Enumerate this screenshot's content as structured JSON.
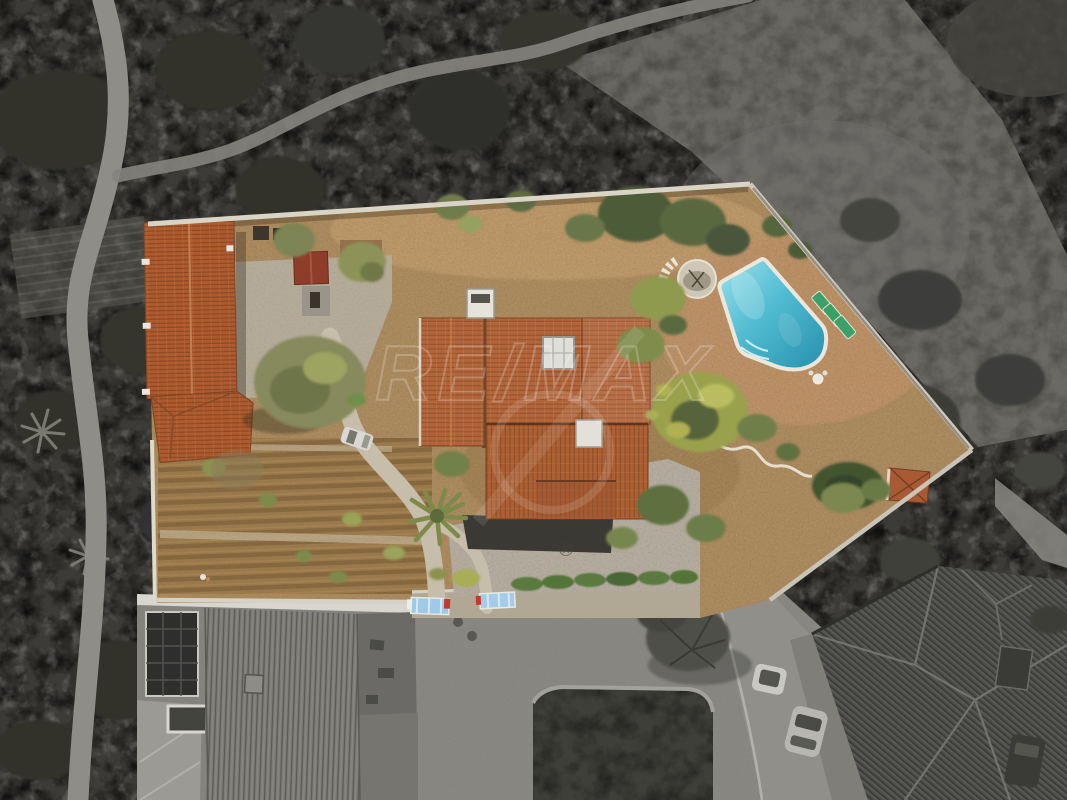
{
  "image": {
    "kind": "aerial drone photograph of a rural property (real-estate listing)",
    "width_px": 1067,
    "height_px": 800,
    "effect": "property lot shown in color, all surroundings desaturated to grayscale"
  },
  "watermark": {
    "text": "RE/MAX",
    "registered_symbol": "®"
  },
  "palette": {
    "surround_dark_scrub": "#3c3b37",
    "open_hillside": "#6e6d67",
    "dirt_ground": "#a9885c",
    "terracotta_roof": "#b2653a",
    "outbuilding_roof": "#ad5a2e",
    "red_shed_roof": "#8e3d2b",
    "pool_water_light": "#9ce2ea",
    "pool_water_deep": "#2690ac",
    "pool_rim": "#ebe7dd",
    "lounger_green": "#3ba06a",
    "concrete_path": "#c6bdab",
    "boundary_wall": "#d9d4c6",
    "hedge_green": "#5a7a40",
    "gate_blue": "#9ec9e8",
    "road_asphalt": "#888782",
    "gray_house_roof": "#4d4d4a",
    "solar_panels": "#2e2e2c",
    "olive_tree": "#868a5c",
    "bright_tree": "#9aa14e"
  },
  "scene": {
    "property": {
      "boundary": "walled polygon lot, wide at top, tapering to street at bottom",
      "features": [
        "long terracotta-roof outbuilding on west side",
        "small red-roof shed by courtyard",
        "concrete courtyard",
        "large olive tree",
        "main house with terracotta roofs, white chimney, skylight and roof vent",
        "palm tree south-west of house",
        "curved concrete garden path to street gates",
        "vegetable garden with planted rows",
        "swimming pool with rounded roman end and white rim",
        "three green sun loungers",
        "round stone patio with curved steps",
        "small terracotta shed on east corner wall",
        "white car parked by path",
        "gravel driveway",
        "green hedge along sidewalk",
        "two blue construction barriers at gates"
      ]
    },
    "surroundings": {
      "features": [
        "dark scrubland and trees (grayscale)",
        "dirt footpath along left edge",
        "curved trail to hill at top",
        "open bare hillside top right",
        "striped farm field patch on left",
        "industrial building with solar panel array bottom left",
        "asphalt road and junction at bottom",
        "dark fenced garden patch in road bend",
        "bare street tree over road",
        "parked cars along street",
        "large gray hipped-roof house bottom right"
      ]
    }
  }
}
